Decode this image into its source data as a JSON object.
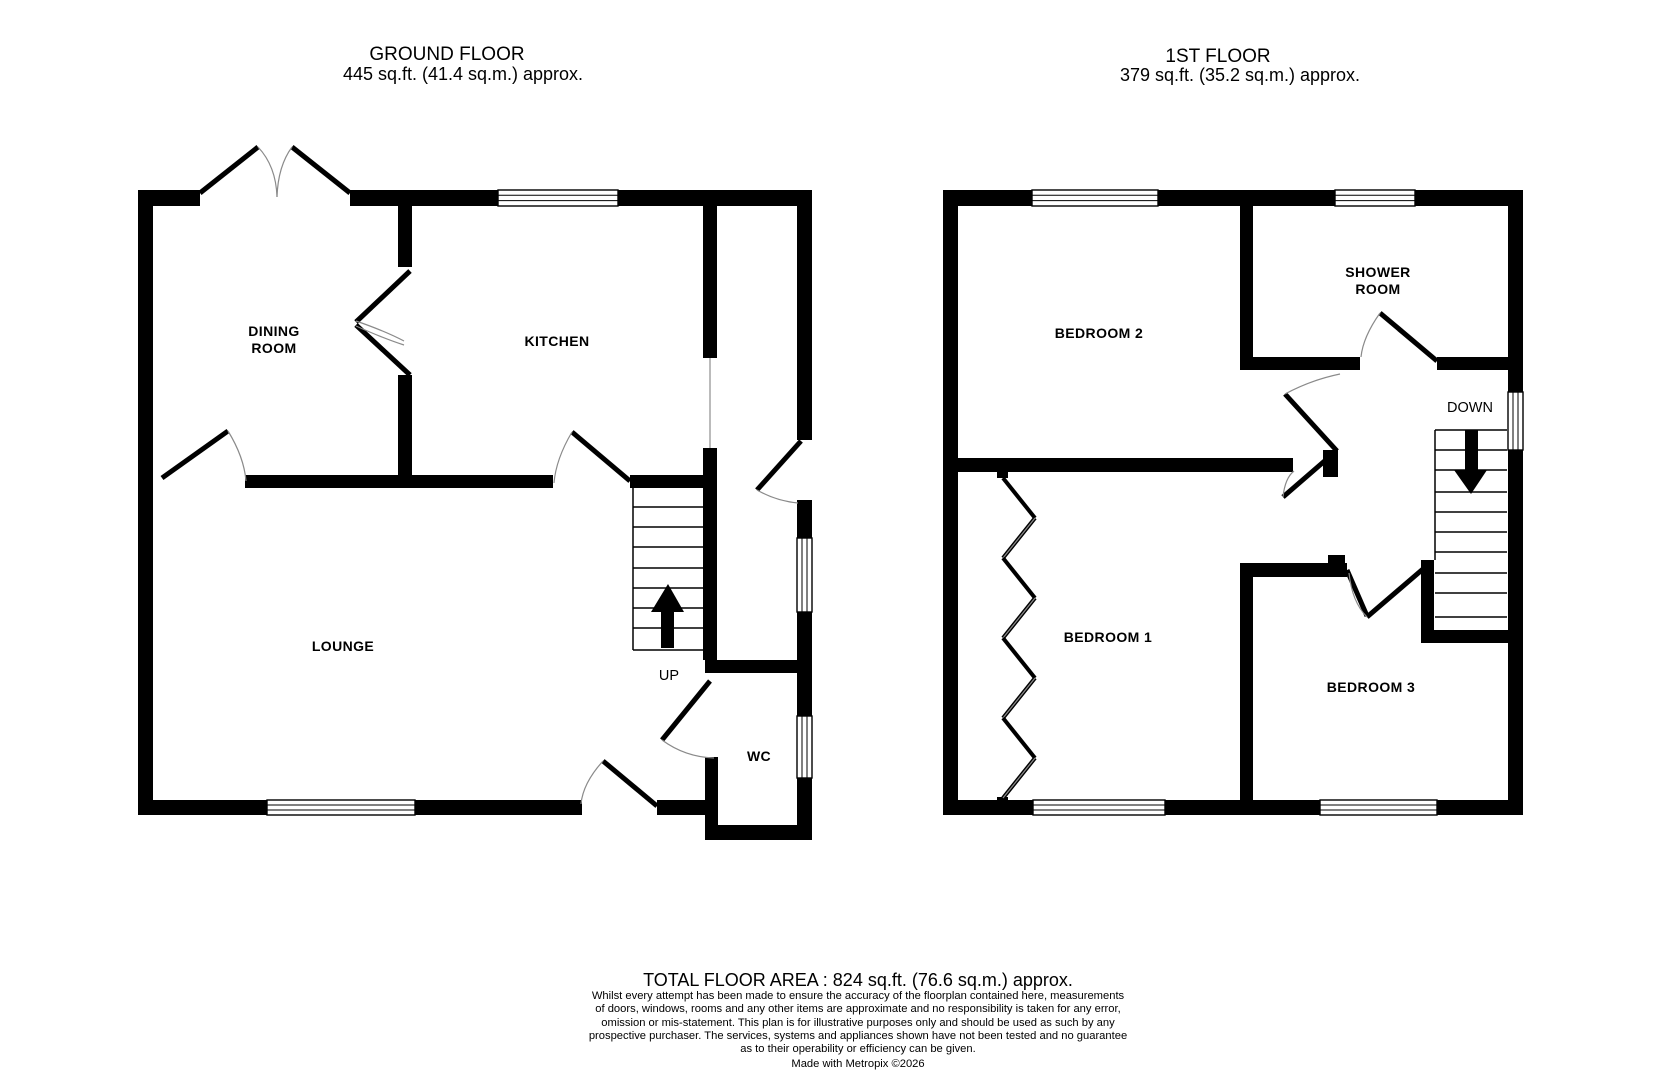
{
  "ground_floor": {
    "title": "GROUND FLOOR",
    "area_line": "445 sq.ft. (41.4 sq.m.) approx.",
    "rooms": {
      "dining_line1": "DINING",
      "dining_line2": "ROOM",
      "kitchen": "KITCHEN",
      "lounge": "LOUNGE",
      "wc": "WC"
    },
    "stairs_label": "UP"
  },
  "first_floor": {
    "title": "1ST FLOOR",
    "area_line": "379 sq.ft. (35.2 sq.m.) approx.",
    "rooms": {
      "bedroom2": "BEDROOM 2",
      "shower_line1": "SHOWER",
      "shower_line2": "ROOM",
      "bedroom1": "BEDROOM 1",
      "bedroom3": "BEDROOM 3"
    },
    "stairs_label": "DOWN"
  },
  "footer": {
    "total_area": "TOTAL FLOOR AREA : 824 sq.ft. (76.6 sq.m.) approx.",
    "disclaimer_lines": [
      "Whilst every attempt has been made to ensure the accuracy of the floorplan contained here, measurements",
      "of doors, windows, rooms and any other items are approximate and no responsibility is taken for any error,",
      "omission or mis-statement. This plan is for illustrative purposes only and should be used as such by any",
      "prospective purchaser. The services, systems and appliances shown have not been tested and no guarantee",
      "as to their operability or efficiency can be given."
    ],
    "credit": "Made with Metropix ©2026"
  },
  "colors": {
    "wall": "#000000",
    "background": "#ffffff",
    "door_arc": "#8a8a8a"
  }
}
